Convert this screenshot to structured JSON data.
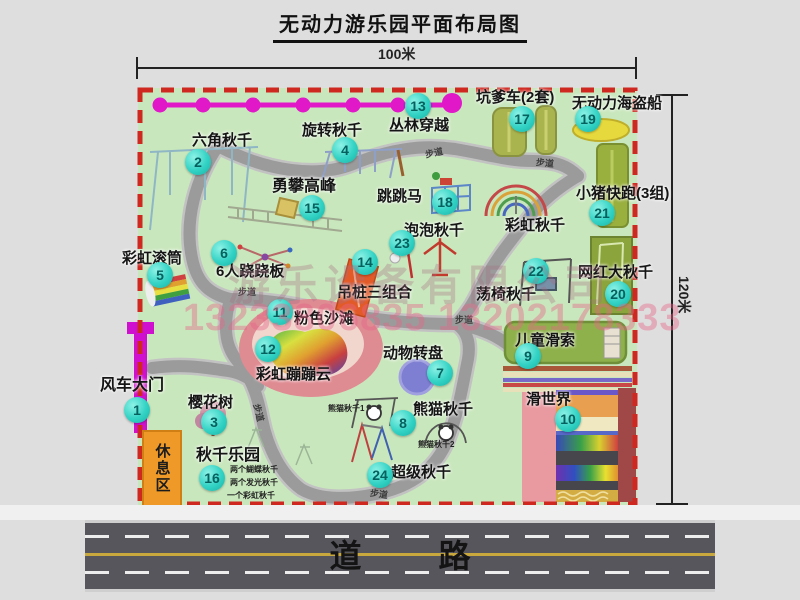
{
  "title": "无动力游乐园平面布局图",
  "dimensions": {
    "horizontal": "100米",
    "vertical": "120米"
  },
  "road_label": "道 路",
  "rest_area_label": "休息区",
  "walkway_label": "步道",
  "watermark": {
    "company": "游乐设备有限公司",
    "phone": "13233806835 13202178333"
  },
  "colors": {
    "map_green": "#c9e7bd",
    "border_red": "#cf2820",
    "badge_teal": "#32d2c4",
    "gate_magenta": "#cf10cf",
    "trail_gray": "#9b9b9b",
    "road_dark": "#56565c",
    "rest_orange": "#ef9a28",
    "beach_pink": "#df8b92"
  },
  "attractions": {
    "gate": {
      "num": "1",
      "name": "风车大门"
    },
    "hex_swing": {
      "num": "2",
      "name": "六角秋千"
    },
    "cherry_tree": {
      "num": "3",
      "name": "樱花树"
    },
    "rotate_swing": {
      "num": "4",
      "name": "旋转秋千"
    },
    "rainbow_roller": {
      "num": "5",
      "name": "彩虹滚筒"
    },
    "seesaw6": {
      "num": "6",
      "name": "6人跷跷板"
    },
    "animal_wheel": {
      "num": "7",
      "name": "动物转盘"
    },
    "panda_swing": {
      "num": "8",
      "name": "熊猫秋千",
      "sub1": "熊猫秋千1",
      "sub2": "熊猫秋千2"
    },
    "kids_zipline": {
      "num": "9",
      "name": "儿童滑索"
    },
    "slide_world": {
      "num": "10",
      "name": "滑世界"
    },
    "pink_beach": {
      "num": "11",
      "name": "粉色沙滩"
    },
    "rainbow_cloud": {
      "num": "12",
      "name": "彩虹蹦蹦云"
    },
    "jungle_cross": {
      "num": "13",
      "name": "丛林穿越"
    },
    "hang_piles": {
      "num": "14",
      "name": "吊桩三组合"
    },
    "climb_peak": {
      "num": "15",
      "name": "勇攀高峰"
    },
    "swing_park": {
      "num": "16",
      "name": "秋千乐园",
      "sub1": "两个蝴蝶秋千",
      "sub2": "两个发光秋千",
      "sub3": "一个彩虹秋千"
    },
    "pit_cars": {
      "num": "17",
      "name": "坑爹车(2套)"
    },
    "jump_horse": {
      "num": "18",
      "name": "跳跳马"
    },
    "pirate_ship": {
      "num": "19",
      "name": "无动力海盗船"
    },
    "big_swing": {
      "num": "20",
      "name": "网红大秋千"
    },
    "piggy_run": {
      "num": "21",
      "name": "小猪快跑(3组)"
    },
    "chair_swing": {
      "num": "22",
      "name": "荡椅秋千"
    },
    "bubble_swing": {
      "num": "23",
      "name": "泡泡秋千"
    },
    "super_swing": {
      "num": "24",
      "name": "超级秋千"
    },
    "rainbow_swing": {
      "name": "彩虹秋千"
    }
  }
}
